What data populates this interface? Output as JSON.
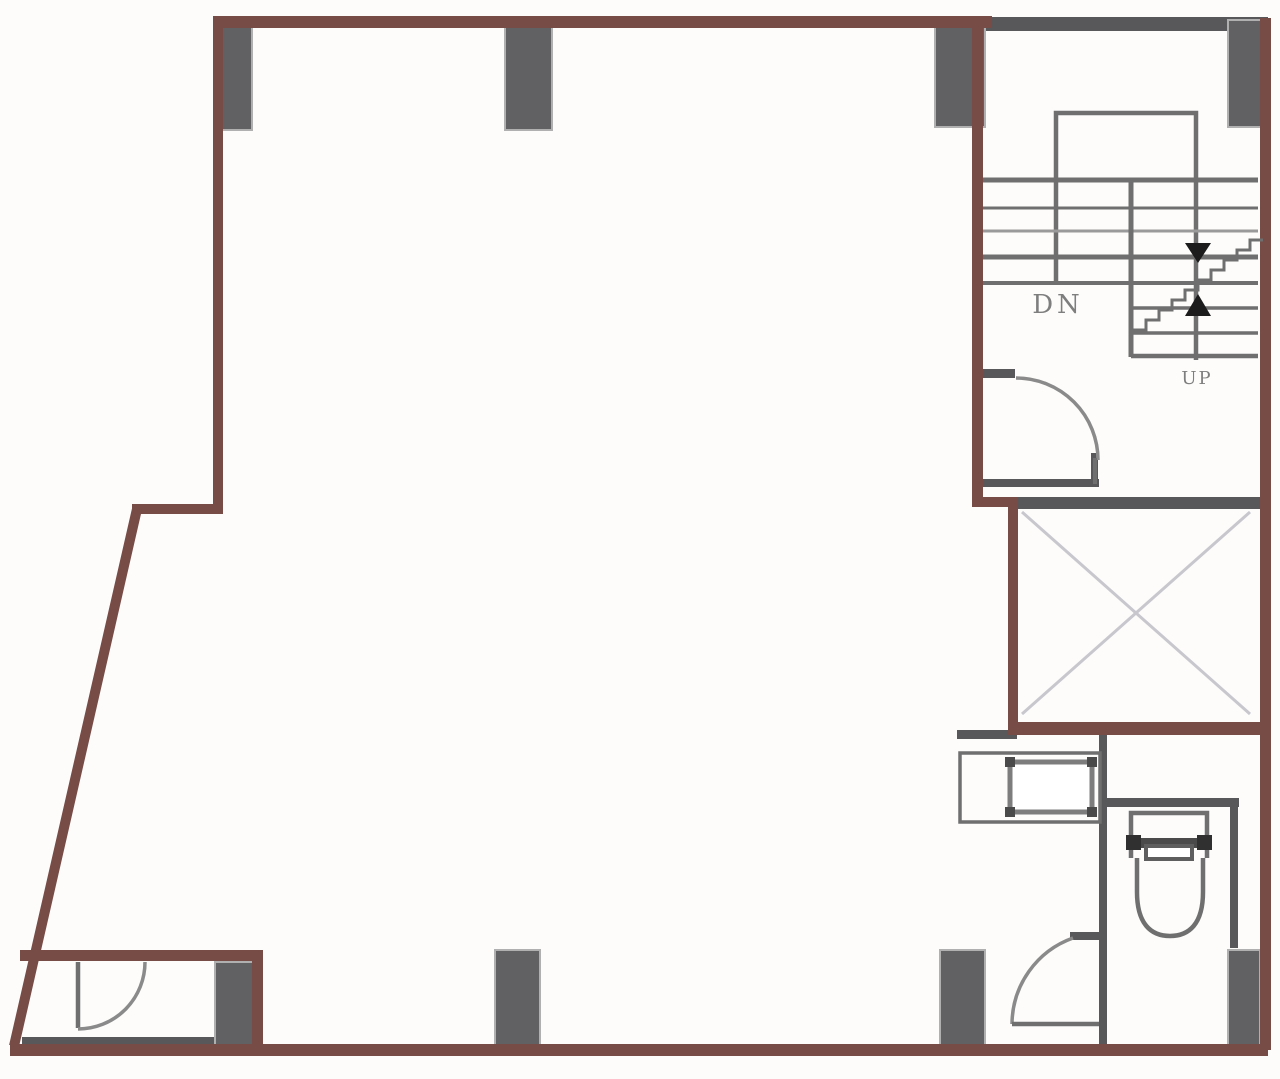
{
  "labels": {
    "stair_down": "DN",
    "stair_up": "UP"
  },
  "icons": {
    "stair_down_arrow": "triangle-down-icon",
    "stair_up_arrow": "triangle-up-icon",
    "elevator_cross": "x-cross-icon",
    "door_swing": "quarter-arc-icon"
  },
  "features": [
    "staircase",
    "elevator-shaft",
    "toilet",
    "sink-counter",
    "door-swing",
    "structural-column"
  ],
  "colors": {
    "wall": "#774b46",
    "gray_wall": "#58585a",
    "column": "#616163",
    "column_outline": "#b0b0b0",
    "line": "#6f6f6f",
    "light_line": "#9a9a9a",
    "arc": "#8a8a8a",
    "cross": "#c7c7cd",
    "arrow": "#1c1c1c",
    "dark_fixture": "#4a4a4a",
    "text": "#7e7e7e",
    "background": "#fdfcfb"
  }
}
